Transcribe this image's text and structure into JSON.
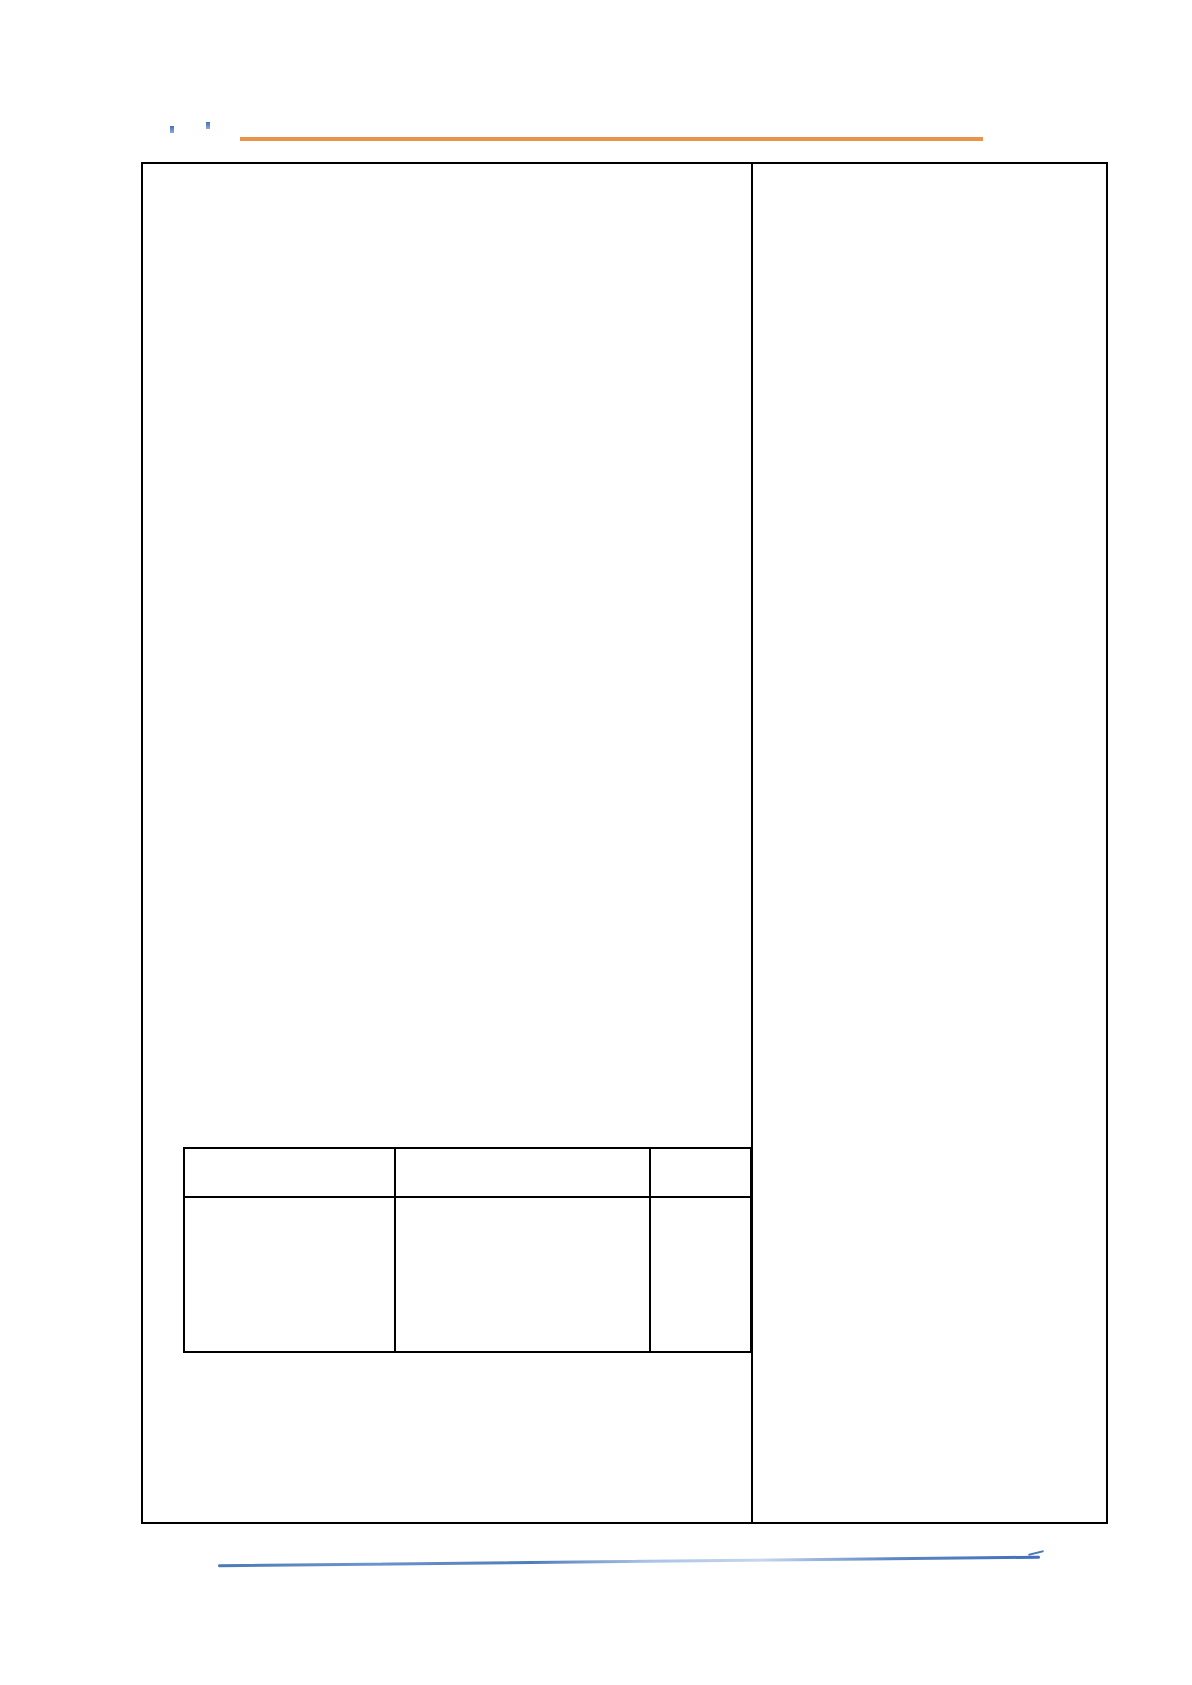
{
  "page": {
    "background_color": "#ffffff",
    "kind": "blank-document-scan"
  },
  "annotation_marks": {
    "color": "#3f6fbe",
    "count": 2
  },
  "top_rule": {
    "color": "#e8954a"
  },
  "content_frame": {
    "border_color": "#000000",
    "columns": 2
  },
  "inner_table": {
    "border_color": "#000000",
    "rows": 2,
    "columns": 3,
    "cells": [
      [
        "",
        "",
        ""
      ],
      [
        "",
        "",
        ""
      ]
    ]
  },
  "bottom_rule": {
    "color": "#4a79b8",
    "style": "hand-drawn"
  }
}
